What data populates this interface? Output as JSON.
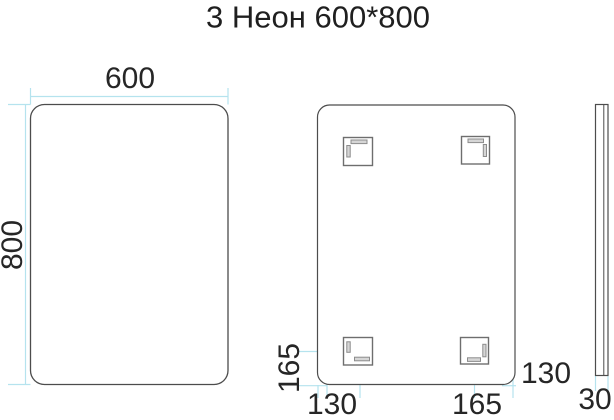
{
  "title": "3 Неон 600*800",
  "colors": {
    "outline": "#4c4c4c",
    "bracket_outline": "#6e6e6e",
    "slot_fill": "#d6d6d6",
    "slot_outline": "#8c8c8c",
    "dimension_line": "#b5e3ee",
    "text": "#262626"
  },
  "views": {
    "front": {
      "width_label": "600",
      "height_label": "800"
    },
    "back": {
      "left_offset_label": "165",
      "bottom_left_offset_label": "130",
      "bottom_right_offset_label": "165",
      "right_offset_label": "130"
    },
    "side": {
      "depth_label": "30"
    }
  }
}
